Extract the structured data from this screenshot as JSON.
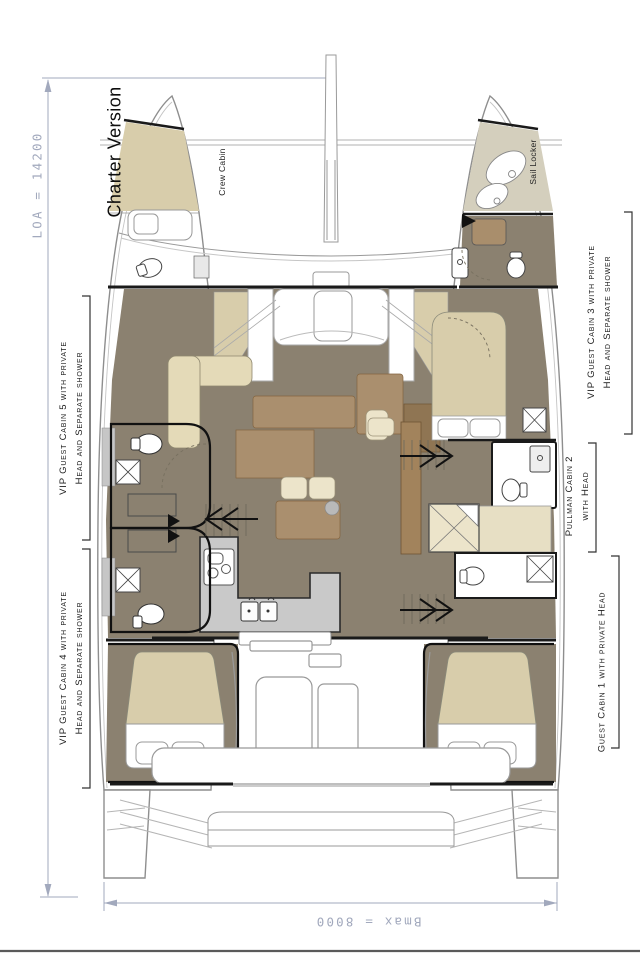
{
  "title": "Catamaran layout plan - Charter Version",
  "labels": {
    "charter_version": "Charter Version",
    "loa": "LOA = 14200",
    "bmax": "Bmax = 8000",
    "crew_cabin": "Crew Cabin",
    "sail_locker": "Sail Locker",
    "cabin5": {
      "line1": "VIP Guest Cabin 5 with private",
      "line2": "Head and Separate shower"
    },
    "cabin4": {
      "line1": "VIP Guest Cabin 4 with private",
      "line2": "Head and Separate shower"
    },
    "cabin3": {
      "line1": "VIP Guest Cabin 3 with private",
      "line2": "Head and Separate shower"
    },
    "pullman2": {
      "line1": "Pullman Cabin 2",
      "line2": "with Head"
    },
    "cabin1": "Guest Cabin 1 with private Head"
  },
  "dimensions": {
    "loa_mm": 14200,
    "bmax_mm": 8000
  },
  "colors": {
    "floor_olive": "#8b8170",
    "bed_tan": "#d8cdab",
    "cushion_cream": "#ece4ca",
    "wood_brown": "#aa8f6e",
    "dark_wood": "#8f7553",
    "counter_gray": "#c9c9c9",
    "dimension_blue": "#a2a9bd",
    "outline_black": "#1a1a1a",
    "hull_stroke": "#8e8e8e"
  }
}
